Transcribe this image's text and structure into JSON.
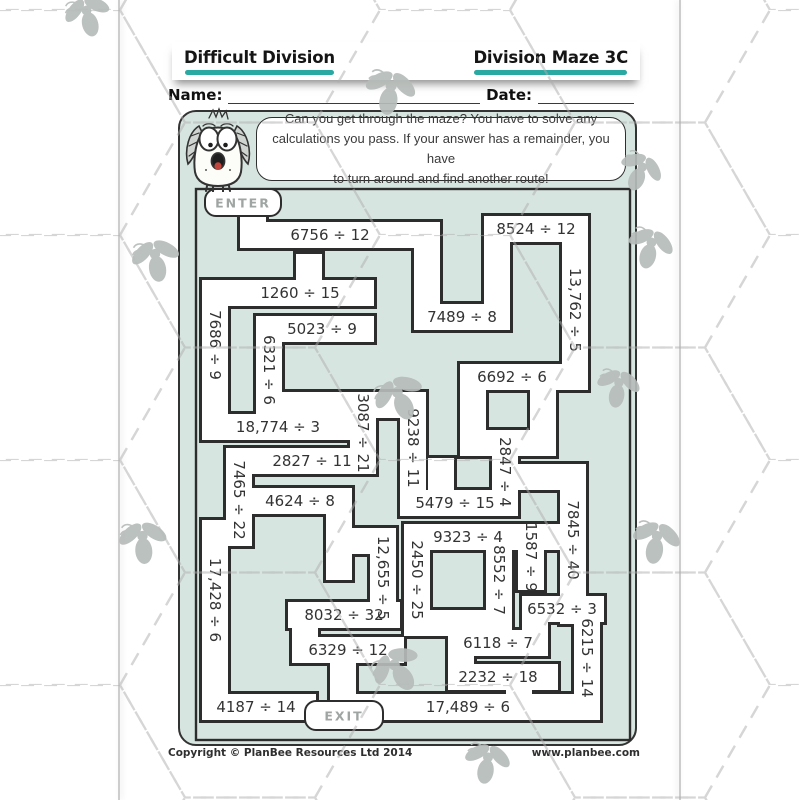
{
  "page": {
    "header": {
      "title_left": "Difficult Division",
      "title_right": "Division Maze 3C"
    },
    "name_label": "Name:",
    "date_label": "Date:",
    "instructions_lines": [
      "Can you get through the maze? You have to solve any",
      "calculations you pass. If your answer has a remainder, you have",
      "to turn around and find another route!"
    ],
    "enter_label": "ENTER",
    "exit_label": "EXIT",
    "footer_left": "Copyright © PlanBee Resources Ltd 2014",
    "footer_right": "www.planbee.com",
    "colors": {
      "mint": "#d7e5e0",
      "wall": "#2d2d2d",
      "corridor": "#ffffff",
      "teal_underline": "#2aa8a2",
      "button_text": "#9fa5a3",
      "problem_text": "#333333",
      "fly": "#b6bcb9",
      "pattern_line": "#aeaeae"
    }
  },
  "maze": {
    "problems": [
      {
        "text": "6756 ÷ 12",
        "orient": "h",
        "x": 330,
        "y": 235
      },
      {
        "text": "8524 ÷ 12",
        "orient": "h",
        "x": 536,
        "y": 229
      },
      {
        "text": "1260 ÷ 15",
        "orient": "h",
        "x": 300,
        "y": 293
      },
      {
        "text": "7489 ÷ 8",
        "orient": "h",
        "x": 462,
        "y": 317
      },
      {
        "text": "13,762 ÷ 5",
        "orient": "v",
        "x": 575,
        "y": 310
      },
      {
        "text": "7686 ÷ 9",
        "orient": "v",
        "x": 215,
        "y": 345
      },
      {
        "text": "5023 ÷ 9",
        "orient": "h",
        "x": 322,
        "y": 329
      },
      {
        "text": "6321 ÷ 6",
        "orient": "v",
        "x": 269,
        "y": 370
      },
      {
        "text": "6692 ÷ 6",
        "orient": "h",
        "x": 512,
        "y": 377
      },
      {
        "text": "9238 ÷ 11",
        "orient": "v",
        "x": 413,
        "y": 448
      },
      {
        "text": "3087 ÷ 21",
        "orient": "v",
        "x": 363,
        "y": 433
      },
      {
        "text": "18,774 ÷ 3",
        "orient": "h",
        "x": 278,
        "y": 427
      },
      {
        "text": "2847 ÷ 4",
        "orient": "v",
        "x": 505,
        "y": 472
      },
      {
        "text": "2827 ÷ 11",
        "orient": "h",
        "x": 312,
        "y": 461
      },
      {
        "text": "7465 ÷ 22",
        "orient": "v",
        "x": 239,
        "y": 500
      },
      {
        "text": "4624 ÷ 8",
        "orient": "h",
        "x": 300,
        "y": 501
      },
      {
        "text": "5479 ÷ 15",
        "orient": "h",
        "x": 455,
        "y": 503
      },
      {
        "text": "7845 ÷ 40",
        "orient": "v",
        "x": 573,
        "y": 540
      },
      {
        "text": "9323 ÷ 4",
        "orient": "h",
        "x": 468,
        "y": 537
      },
      {
        "text": "12,655 ÷ 5",
        "orient": "v",
        "x": 383,
        "y": 578
      },
      {
        "text": "2450 ÷ 25",
        "orient": "v",
        "x": 417,
        "y": 580
      },
      {
        "text": "8552 ÷ 7",
        "orient": "v",
        "x": 499,
        "y": 580
      },
      {
        "text": "1587 ÷ 9",
        "orient": "v",
        "x": 531,
        "y": 557
      },
      {
        "text": "17,428 ÷ 6",
        "orient": "v",
        "x": 215,
        "y": 600
      },
      {
        "text": "8032 ÷ 32",
        "orient": "h",
        "x": 344,
        "y": 615
      },
      {
        "text": "6532 ÷ 3",
        "orient": "h",
        "x": 562,
        "y": 609
      },
      {
        "text": "6329 ÷ 12",
        "orient": "h",
        "x": 348,
        "y": 650
      },
      {
        "text": "6118 ÷ 7",
        "orient": "h",
        "x": 498,
        "y": 643
      },
      {
        "text": "6215 ÷ 14",
        "orient": "v",
        "x": 587,
        "y": 658
      },
      {
        "text": "2232 ÷ 18",
        "orient": "h",
        "x": 498,
        "y": 677
      },
      {
        "text": "4187 ÷ 14",
        "orient": "h",
        "x": 256,
        "y": 707
      },
      {
        "text": "17,489 ÷ 6",
        "orient": "h",
        "x": 468,
        "y": 707
      }
    ]
  }
}
